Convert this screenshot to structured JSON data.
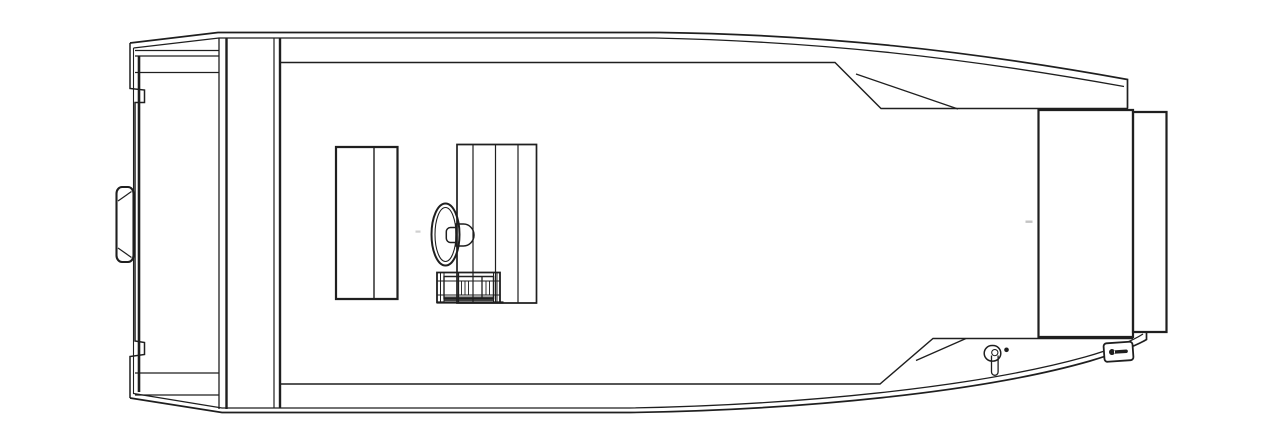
{
  "canvas": {
    "width": 1280,
    "height": 448,
    "background": "#ffffff",
    "stroke": "#1f1f1f",
    "default_stroke_width": 1.4
  },
  "drawing": {
    "kind": "line-drawing",
    "parts": [
      {
        "name": "gunwale-top-outer",
        "d": "M130,43 L218,32.5 H660 C820,34.5 965,50 1127.5,79.5 V108.5",
        "w": 1.7
      },
      {
        "name": "gunwale-top-inner",
        "d": "M133.5,48 L219,38 H655 C815,41.5 958,56.5 1124,86.5",
        "w": 1.3
      },
      {
        "name": "stern-port-edge",
        "d": "M130,43 V88.5 L144.5,90 V102.5 L135,102.5 V341 L144.5,342.5 V354.5 L130,356.5 V398",
        "w": 1.5
      },
      {
        "name": "stern-port-edge-inner",
        "d": "M133.5,48 V394",
        "w": 1.1
      },
      {
        "name": "stern-port-edge-thick",
        "d": "M139,56 V392",
        "w": 2.6
      },
      {
        "name": "transom-top-step-lines",
        "d": "M135,50.5 H219 M135,56 H219 M135,72.5 H219",
        "w": 1.3
      },
      {
        "name": "transom-bottom-step-lines",
        "d": "M135,373 H219 M135,395 H219",
        "w": 1.3
      },
      {
        "name": "transom-inner-wall",
        "d": "M219,38 V409",
        "w": 1.3
      },
      {
        "name": "transom-inner-wall-thick",
        "d": "M226.5,38 V409",
        "w": 2.4
      },
      {
        "name": "stern-bench-front",
        "d": "M274,38.5 V408.5",
        "w": 1.2
      },
      {
        "name": "stern-bench-front-thick",
        "d": "M280,38.5 V408.5",
        "w": 2.4
      },
      {
        "name": "cockpit-coaming-top",
        "d": "M280,62.5 H835 L881,108.5 H1128",
        "w": 1.4
      },
      {
        "name": "cockpit-top-corner-line",
        "d": "M856,74 L958,109",
        "w": 1.3
      },
      {
        "name": "cockpit-coaming-bottom",
        "d": "M280,384 H880 L933,338.5 H1133",
        "w": 1.4
      },
      {
        "name": "cockpit-bottom-corner-line",
        "d": "M916,360.5 L966,338.5",
        "w": 1.3
      },
      {
        "name": "hull-bottom-outer",
        "d": "M130,398 L222,412.5 H630 C800,410 980,392.5 1090,361 C1115,353.5 1136,346 1146.5,339.5 V332",
        "w": 1.7
      },
      {
        "name": "hull-bottom-inner",
        "d": "M133.5,393.5 L222,408 H630 C798,405 975,387.5 1085,357 C1112,349.5 1133,340.5 1143,334",
        "w": 1.3
      },
      {
        "name": "bow-casting-deck",
        "d": "M1038.5,110 H1133 V337 H1038.5 Z",
        "w": 2.2
      },
      {
        "name": "bow-step-panel",
        "d": "M1133,112 H1166.5 V332 H1133 Z",
        "w": 2.2
      },
      {
        "name": "port-bench-seat",
        "d": "M336,147 H397.5 V299 H336 Z",
        "w": 2.2
      },
      {
        "name": "port-bench-divider",
        "d": "M374,147 V299",
        "w": 1.4
      },
      {
        "name": "helm-console",
        "d": "M457,144.5 H536.5 V303 H457 Z",
        "w": 1.7
      },
      {
        "name": "helm-console-panel-lines",
        "d": "M473,144.5 V303 M495.5,144.5 V303 M518,144.5 V303",
        "w": 1.2
      },
      {
        "name": "steering-wheel-rim",
        "d": "M431.5,234.5 a14,31 0 1 0 28,0 a14,31 0 1 0 -28,0",
        "w": 2
      },
      {
        "name": "steering-wheel-rim-inner",
        "d": "M435,234.5 a10.5,27 0 1 0 21,0 a10.5,27 0 1 0 -21,0",
        "w": 1.1
      },
      {
        "name": "steering-hub",
        "d": "M456,224 H463.5 A10.5,11 0 0 1 474,235 A10.5,11 0 0 1 463.5,246 H456 V224 Z M456,227.5 H450.5 A4.2,4.2 0 0 0 446.3,231.7 V238.3 A4.2,4.2 0 0 0 450.5,242.5 H456",
        "w": 1.5
      },
      {
        "name": "throttle-unit-body",
        "d": "M437,272.5 H500 V302.5 H437 Z",
        "w": 1.8
      },
      {
        "name": "throttle-unit-inner",
        "d": "M444,276.5 H493.5 V298.5 H444 Z",
        "w": 1.4
      },
      {
        "name": "throttle-left-flange",
        "d": "M440.5,272.5 V302.5 M444,272.5 V302.5",
        "w": 1
      },
      {
        "name": "throttle-right-flange",
        "d": "M493.5,272.5 V302.5 M497,272.5 V302.5",
        "w": 1
      },
      {
        "name": "throttle-mid-rails",
        "d": "M437,281 H500 M437,295 H500",
        "w": 1
      },
      {
        "name": "throttle-dividers",
        "d": "M458.5,272.5 V302.5 M482,276.5 V298.5",
        "w": 1.3
      },
      {
        "name": "throttle-ticks",
        "d": "M461.5,281.5 V294.5 M465,281.5 V294.5 M468.5,281.5 V294.5 M486,281.5 V294.5 M489.5,281.5 V294.5",
        "w": 0.9
      },
      {
        "name": "throttle-shadow-strip",
        "d": "M444,296.5 H493.5 V301 H444 Z",
        "fill": "#1f1f1f",
        "stroke": "none",
        "w": 0,
        "opacity": 0.85
      },
      {
        "name": "throttle-base-plate",
        "d": "M437,302.5 H503.5",
        "w": 2.2
      },
      {
        "name": "stern-bracket",
        "d": "M122,187 H128 A5.5,6.5 0 0 1 133.5,193.5 V255.5 A5.5,6.5 0 0 1 128,262 H122 A5.5,6.5 0 0 1 116.5,255.5 V193.5 A5.5,6.5 0 0 1 122,187 Z",
        "w": 2.1
      },
      {
        "name": "stern-bracket-chamfers",
        "d": "M118,201 L131.5,191.5 M118,248 L131.5,257.5",
        "w": 1.2
      },
      {
        "name": "bow-light-base",
        "d": "M992,345.5 h1 a7.8,7.8 0 0 1 0,15.6 h-1 a7.8,7.8 0 0 1 0,-15.6 Z",
        "w": 1.5
      },
      {
        "name": "bow-light-stem",
        "d": "M991.5,355.5 V372 A3.3,3.3 0 0 0 998.1,372 V355.5",
        "w": 1.3
      },
      {
        "name": "bow-light-stem-cap",
        "d": "M994.8,349.5 a3.1,3.1 0 1 0 0.02,0 Z",
        "w": 1
      },
      {
        "name": "bow-light-dot",
        "d": "M1006.5,347.5 a2.3,2.3 0 1 0 0.02,0 Z",
        "fill": "#1f1f1f",
        "stroke": "none",
        "w": 0
      },
      {
        "name": "bow-hatch-latch-plate",
        "d": "M1107,342.5 H1130 A3,3 0 0 1 1133,345.5 V358 A3,3 0 0 1 1130,361 H1107 A3,3 0 0 1 1104,358 V345.5 A3,3 0 0 1 1107,342.5 Z",
        "w": 1.8,
        "fill": "#ffffff",
        "transform": "rotate(-4 1118.5 351.75)"
      },
      {
        "name": "bow-hatch-latch-key",
        "d": "M1112,348.6 a3,3 0 1 0 0.02,0 Z M1114,350 H1126.5 A1.8,1.8 0 0 1 1126.5,353.5 H1114 Z",
        "fill": "#1f1f1f",
        "stroke": "none",
        "w": 0,
        "transform": "rotate(-4 1118.5 351.75)"
      },
      {
        "name": "deck-seam-artifact-bow",
        "d": "M1025.5,220.5 h7 v2.4 h-7 Z",
        "fill": "#b5b5b5",
        "stroke": "none",
        "w": 0,
        "opacity": 0.8
      },
      {
        "name": "deck-seam-artifact-cockpit",
        "d": "M415.5,230.5 h5 v2.2 h-5 Z",
        "fill": "#c4c4c4",
        "stroke": "none",
        "w": 0,
        "opacity": 0.8
      }
    ]
  }
}
